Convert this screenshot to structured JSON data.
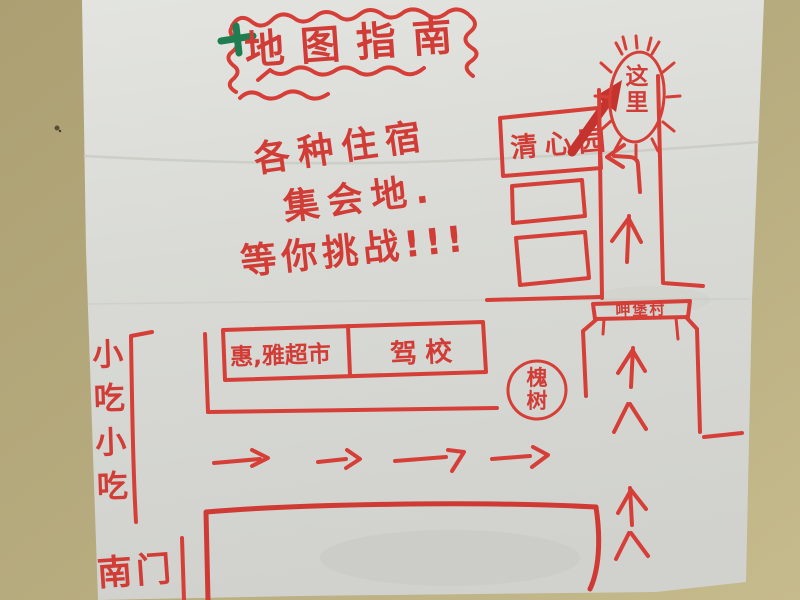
{
  "photo": {
    "background_color": "#b4a97b",
    "paper_color": "#dcddd8",
    "ink_color": "#d63f38",
    "cross_color": "#1f7d52"
  },
  "title": {
    "text": "地图指南",
    "border_style": "hand-drawn wavy cloud",
    "prefix_mark": "green-cross"
  },
  "note_lines": [
    "各种住宿",
    "集会地.",
    "等你挑战!!!"
  ],
  "places": {
    "here_callout": "这里",
    "garden_building": "清心园",
    "gate_sign": "呷堡村",
    "supermarket": "惠,雅超市",
    "driving_school": "驾校",
    "tree": "槐树",
    "snack_street": "小吃小吃",
    "south_gate": "南门"
  },
  "marks": {
    "right_arrow_count": 4,
    "up_arrow_count": 4,
    "left_turn_arrow_count": 1,
    "empty_building_count": 2
  }
}
